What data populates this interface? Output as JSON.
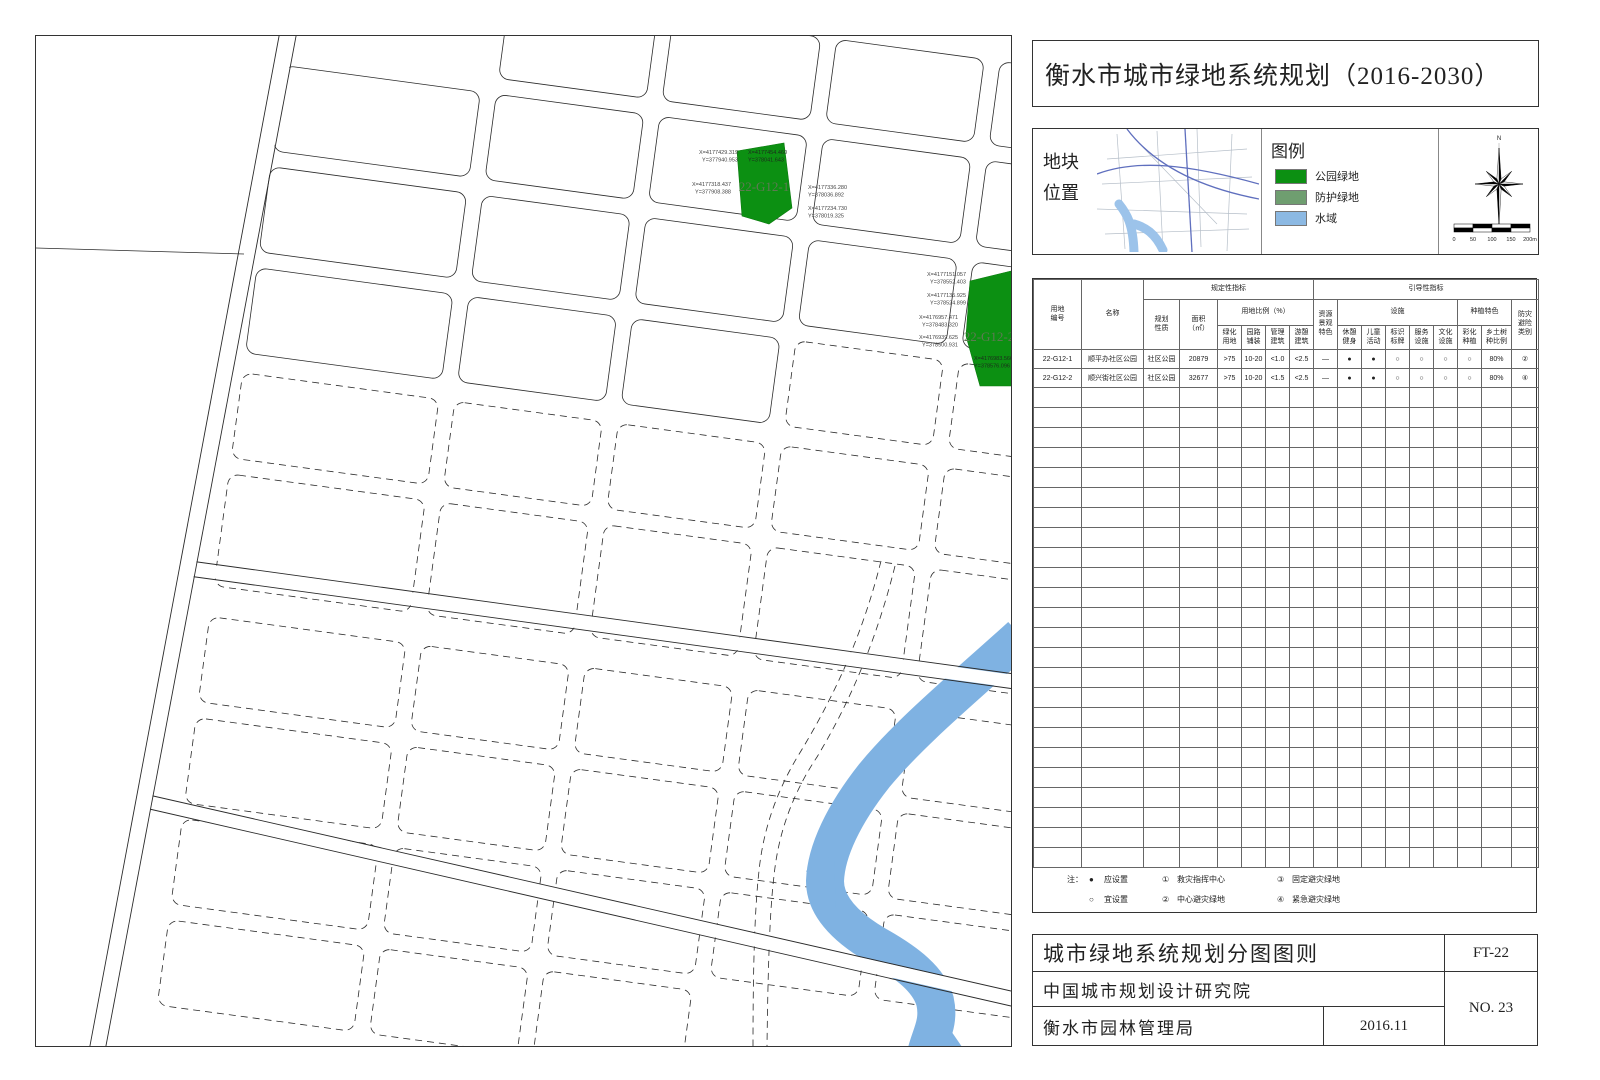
{
  "page_title": "衡水市城市绿地系统规划（2016-2030）",
  "location_panel": {
    "label": "地块\n位置"
  },
  "legend": {
    "title": "图例",
    "items": [
      {
        "label": "公园绿地",
        "color": "#0c9012"
      },
      {
        "label": "防护绿地",
        "color": "#6f9e70"
      },
      {
        "label": "水域",
        "color": "#8cb9e3"
      }
    ]
  },
  "compass": {
    "north_label": "N"
  },
  "scale_bar": {
    "ticks": [
      "0",
      "50",
      "100",
      "150",
      "200m"
    ]
  },
  "map": {
    "parcels": [
      {
        "id": "22-G12-1",
        "annotations": [
          {
            "lines": [
              "X=4177429.319",
              "Y=377940.953"
            ]
          },
          {
            "lines": [
              "X=4177454.460",
              "Y=378041.643"
            ]
          },
          {
            "lines": [
              "X=4177318.437",
              "Y=377908.388"
            ]
          },
          {
            "lines": [
              "X=4177336.280",
              "Y=378036.892"
            ]
          },
          {
            "lines": [
              "X=4177234.730",
              "Y=378019.325"
            ]
          }
        ]
      },
      {
        "id": "22-G12-2",
        "annotations": [
          {
            "lines": [
              "X=4177151.057",
              "Y=378552.403"
            ]
          },
          {
            "lines": [
              "X=4177135.925",
              "Y=378524.899"
            ]
          },
          {
            "lines": [
              "X=4176957.471",
              "Y=378483.320"
            ]
          },
          {
            "lines": [
              "X=4176939.625",
              "Y=378500.931"
            ]
          },
          {
            "lines": [
              "X=4176983.566",
              "Y=378576.096"
            ]
          }
        ]
      }
    ],
    "water_color": "#7fb2e2",
    "park_green_color": "#0c9012"
  },
  "table": {
    "h_parcel_no": "用地\n编号",
    "h_name": "名称",
    "h_prescriptive": "规定性指标",
    "h_guiding": "引导性指标",
    "h_nature": "规划\n性质",
    "h_area": "面积\n（㎡）",
    "h_ratio": "用地比例（%）",
    "h_green": "绿化\n用地",
    "h_path": "园路\n铺装",
    "h_mgmt": "管理\n建筑",
    "h_rec": "游憩\n建筑",
    "h_resource": "资源\n景观\n特色",
    "h_facility": "设施",
    "h_planting": "种植特色",
    "h_fitness": "休憩\n健身",
    "h_children": "儿童\n活动",
    "h_sign": "标识\n标牌",
    "h_service": "服务\n设施",
    "h_culture": "文化\n设施",
    "h_color_plant": "彩化\n种植",
    "h_native": "乡土树\n种比例",
    "h_disaster": "防灾\n避险\n类别",
    "rows": [
      {
        "cells": [
          "22-G12-1",
          "顺平办社区公园",
          "社区公园",
          "20879",
          ">75",
          "10-20",
          "<1.0",
          "<2.5",
          "—",
          "●",
          "●",
          "○",
          "○",
          "○",
          "○",
          "80%",
          "②"
        ]
      },
      {
        "cells": [
          "22-G12-2",
          "顺兴街社区公园",
          "社区公园",
          "32677",
          ">75",
          "10-20",
          "<1.5",
          "<2.5",
          "—",
          "●",
          "●",
          "○",
          "○",
          "○",
          "○",
          "80%",
          "④"
        ]
      }
    ],
    "notes": {
      "label": "注：",
      "filled": "●",
      "filled_text": "应设置",
      "hollow": "○",
      "hollow_text": "宜设置",
      "n1": "①",
      "n1_text": "救灾指挥中心",
      "n2": "②",
      "n2_text": "中心避灾绿地",
      "n3": "③",
      "n3_text": "固定避灾绿地",
      "n4": "④",
      "n4_text": "紧急避灾绿地"
    }
  },
  "title_block": {
    "row1_left": "城市绿地系统规划分图图则",
    "row1_right": "FT-22",
    "row2_left": "中国城市规划设计研究院",
    "row3_left": "衡水市园林管理局",
    "row3_date": "2016.11",
    "sheet_no": "NO. 23"
  }
}
